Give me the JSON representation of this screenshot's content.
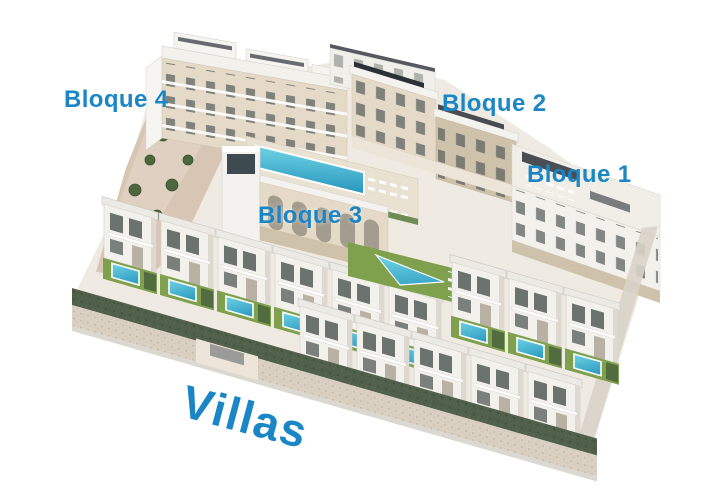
{
  "labels": {
    "bloque4": "Bloque 4",
    "bloque2": "Bloque 2",
    "bloque1": "Bloque 1",
    "bloque3": "Bloque 3",
    "villas": "Villas"
  },
  "colors": {
    "label_blue": "#1b86c6",
    "pool": "#49bcd6",
    "pool_deep": "#2795bd",
    "lawn": "#7fa14e",
    "hedge": "#51604a",
    "wall": "#d9d0c1",
    "facade_beige": "#e4dac7",
    "stone": "#cfc2ab",
    "white_building": "#f3f1ec",
    "window": "#5d6461",
    "roof_panel": "#2c3138",
    "hill": "#d8c6b5",
    "tree": "#4c663e"
  }
}
